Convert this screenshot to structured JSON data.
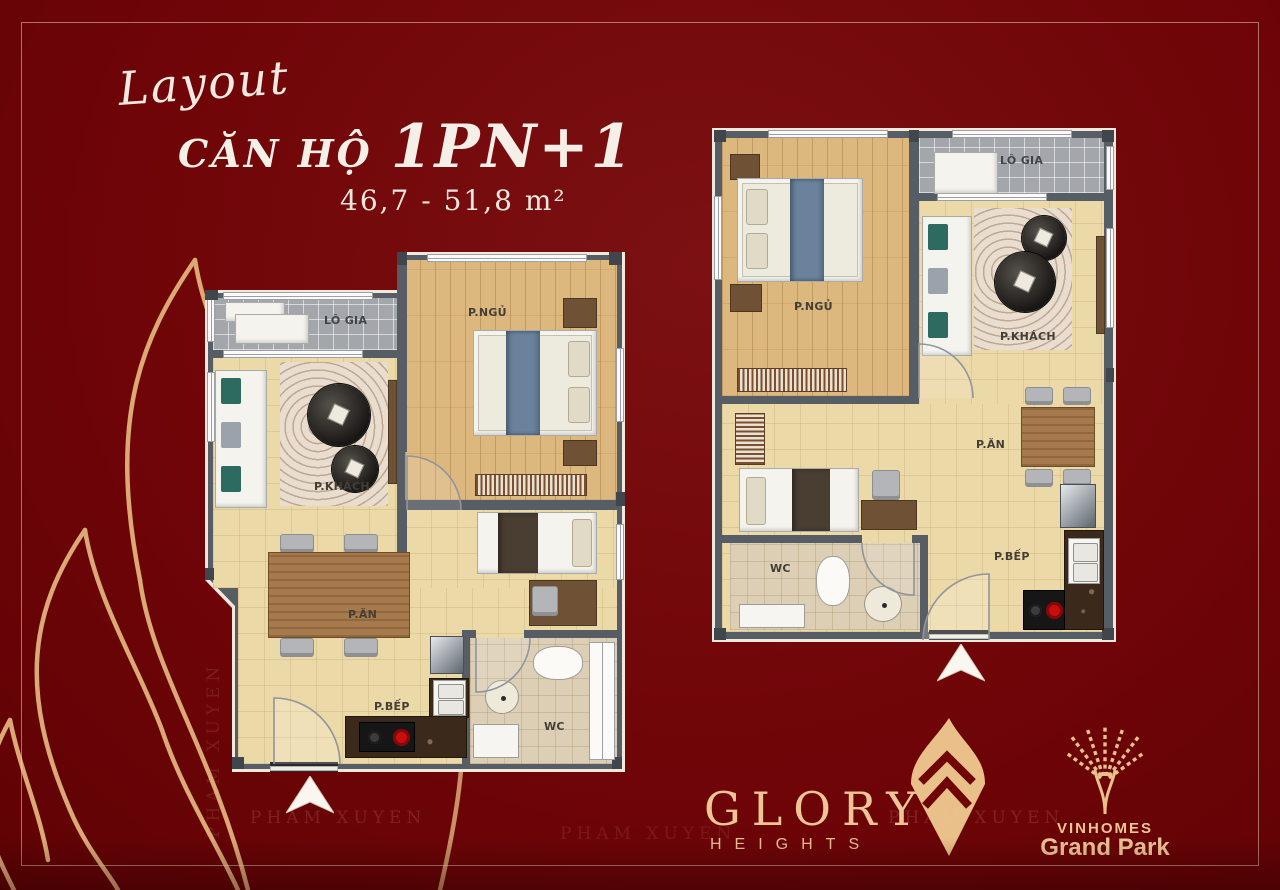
{
  "title": {
    "script": "Layout",
    "unit_label": "CĂN HỘ",
    "unit_type": "1PN+1",
    "area_range": "46,7 - 51,8  m²"
  },
  "plans": {
    "left": {
      "logia": "LÔ GIA",
      "bedroom": "P.NGỦ",
      "living": "P.KHÁCH",
      "dining": "P.ĂN",
      "kitchen": "P.BẾP",
      "wc": "WC"
    },
    "right": {
      "logia": "LÔ GIA",
      "bedroom": "P.NGỦ",
      "living": "P.KHÁCH",
      "dining": "P.ĂN",
      "kitchen": "P.BẾP",
      "wc": "WC"
    }
  },
  "branding": {
    "glory_name": "GLORY",
    "glory_sub": "HEIGHTS",
    "vin_name": "VINHOMES",
    "vin_sub": "Grand Park"
  },
  "watermark": "PHAM XUYEN",
  "colors": {
    "background": "#700508",
    "gold": "#e2b27b",
    "wall": "#575d64",
    "floor": "#ecd9a8",
    "wood": "#dcb87f",
    "blanket_blue": "#6a829c"
  }
}
